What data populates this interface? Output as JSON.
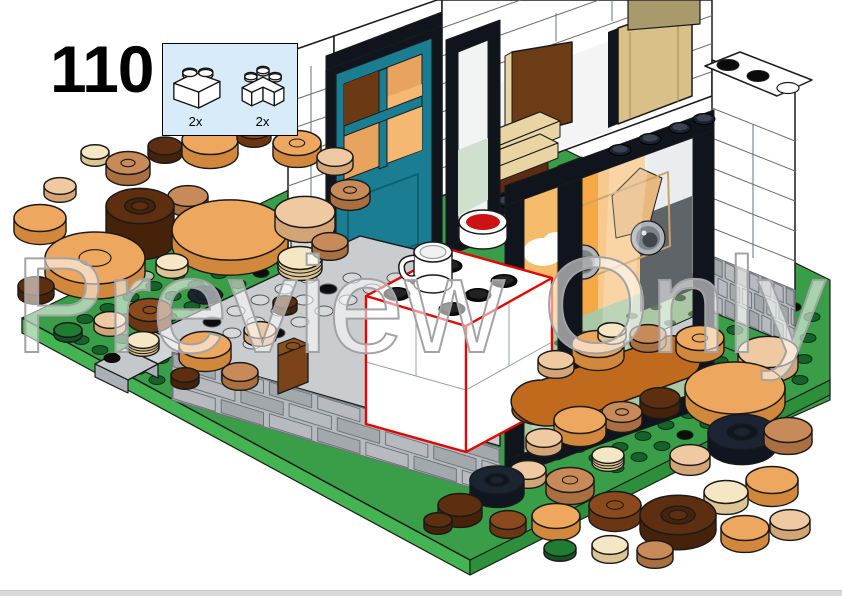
{
  "page": {
    "step_number": "110",
    "watermark_text": "Preview Only",
    "background": "#ffffff",
    "footer_bar_color": "#d9d9d9"
  },
  "parts_callout": {
    "background": "#d7ebf8",
    "border_color": "#000000",
    "parts": [
      {
        "name": "brick-1x2-white",
        "quantity_label": "2x"
      },
      {
        "name": "brick-1x2-corner-white",
        "quantity_label": "2x"
      }
    ]
  },
  "illustration": {
    "description": "Isometric LEGO step view: white storefront with teal door and black display windows, gray stone porch and steps, green baseplate scattered with round pancake pieces; newly placed white bricks outlined in red with a white mug and a red pot on top",
    "colors": {
      "white": "#ffffff",
      "outline": "#1a1a1a",
      "wall_seam": "#6b7075",
      "teal": "#1a7d91",
      "teal_dark": "#11606f",
      "frame_black": "#10151d",
      "glass": "#e9edef",
      "orange_wall": "#f5a843",
      "orange_light": "#f8c98e",
      "orange_accent": "#f08a1e",
      "sage": "#abc8a4",
      "sage_stud": "#5f7a58",
      "arm_tan": "#e7b97e",
      "seat_gray": "#5e6468",
      "cam_light": "#aeb3b7",
      "cam_mid": "#7d8388",
      "cam_dark": "#3f464d",
      "gray_light": "#c9cdd0",
      "gray_mid": "#aab0b4",
      "gray_dark": "#7c8287",
      "stone_fill": "#b7bbbf",
      "stone_alt": "#a2a8ac",
      "stone_line": "#6e7478",
      "green_top": "#3a9d47",
      "green_bright": "#44b352",
      "green_side": "#2e8f3b",
      "green_stud": "#16622a",
      "brown_panel": "#6b3c16",
      "tan_brick": "#e8d5a3",
      "tan_brick_side": "#cdb377",
      "dark_base": "#5a2c12",
      "red_outline": "#e10600",
      "red_fill": "#cc1212",
      "watermark_stroke": "#a3a3a3",
      "callout_bg": "#d7ebf8",
      "callout_border": "#000000",
      "footer_bar": "#d9d9d9"
    },
    "disc_colors": {
      "lt_orange": [
        "#eda75f",
        "#d1883c"
      ],
      "nougat": [
        "#c88a58",
        "#a96f40"
      ],
      "peach": [
        "#eec9a1",
        "#d3a576"
      ],
      "cream": [
        "#f6e7c4",
        "#dcc493"
      ],
      "dk_brown": [
        "#5d2f10",
        "#452209"
      ],
      "rd_brown": [
        "#8a4a1d",
        "#6b3712"
      ],
      "dk_orange": [
        "#c06a1d",
        "#9e5514"
      ],
      "navy": [
        "#1b2433",
        "#10161f"
      ],
      "green_tile": [
        "#1e7c33",
        "#145423"
      ]
    }
  }
}
